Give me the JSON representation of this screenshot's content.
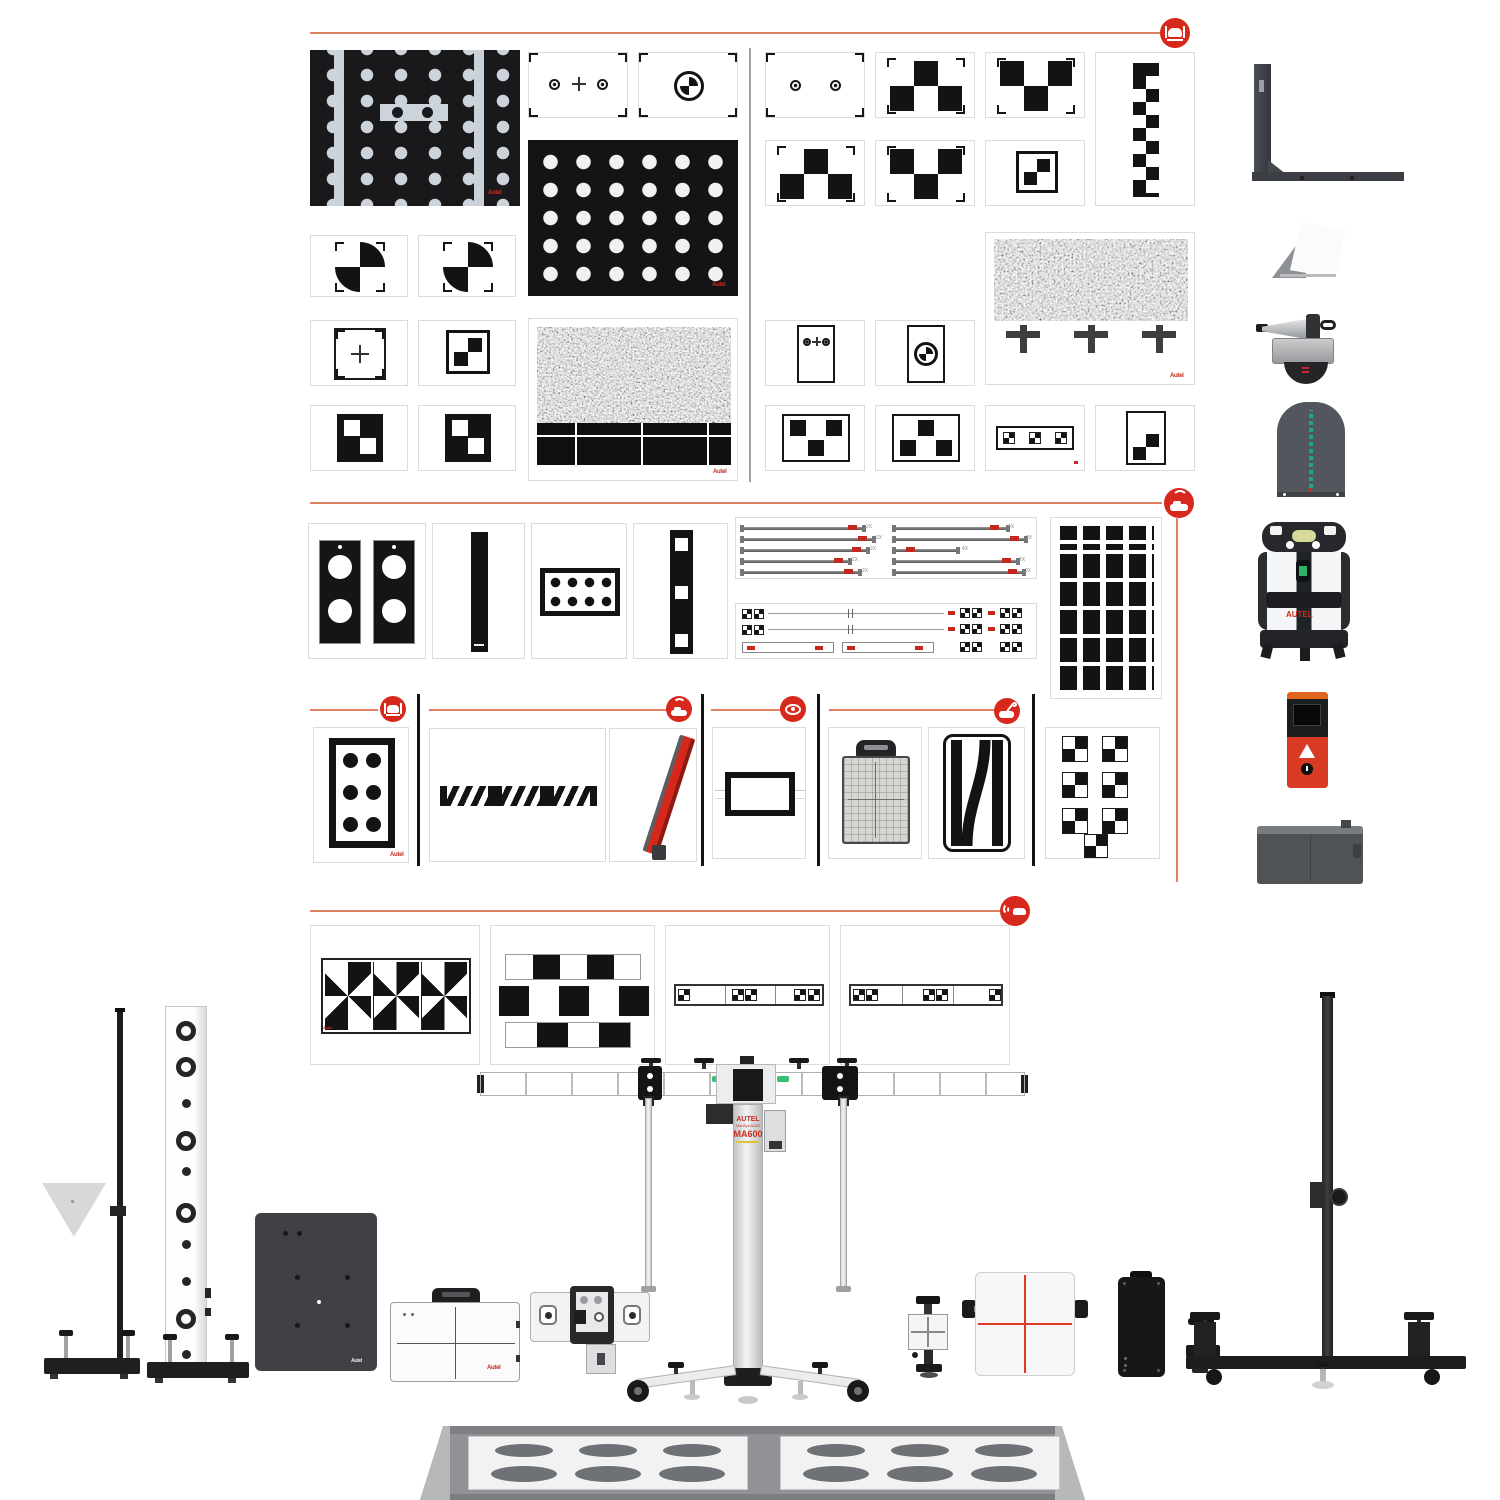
{
  "colors": {
    "accent_red": "#d6281c",
    "section_line": "#e08160",
    "teal": "#17a88e",
    "green": "#2fb36b",
    "board_dark": "#19191c"
  },
  "brand": {
    "logo": "Autel"
  },
  "ma600": {
    "brand": "AUTEL",
    "series": "MaxiSys ADAS",
    "model": "MA600"
  },
  "laser_level": {
    "brand": "AUTEL"
  },
  "rods": {
    "left": [
      "2X",
      "2X",
      "2X",
      "2X",
      "2X"
    ],
    "right": [
      "4X",
      "2X",
      "4X",
      "2X",
      "2X"
    ]
  },
  "sections": [
    {
      "id": "front-camera-targets",
      "icon": "car-camera-icon",
      "items": [
        "dot-matrix-board",
        "two-dot-cross-target",
        "roundel-target",
        "dot-matrix-board-2",
        "quadrant-target",
        "quadrant-target",
        "cross-target",
        "checker-frame-target",
        "noise-grid-target",
        "corner-checker-target",
        "corner-checker-target",
        "two-dot-target",
        "checkerboard-3x2",
        "checkerboard-3x2",
        "zigzag-checker-strip",
        "checkerboard-3x2",
        "checkerboard-3x2",
        "checker-2x2-frame",
        "noise-triple-cross-target",
        "portrait-two-dot-target",
        "portrait-roundel-target",
        "three-square-down-target",
        "three-square-up-target",
        "triple-checker-strip",
        "mini-checkerboard-target"
      ]
    },
    {
      "id": "radar-targets",
      "icon": "car-radar-icon",
      "items": [
        "double-circle-plates",
        "black-bar-target",
        "eight-dot-target",
        "three-square-bar",
        "telescoping-rods",
        "measuring-tapes",
        "grid-block-target"
      ]
    },
    {
      "id": "special-targets",
      "groups": [
        {
          "icon": "car-camera-icon",
          "items": [
            "six-dot-target"
          ]
        },
        {
          "icon": "car-radar-icon",
          "items": [
            "striped-bar-target",
            "red-reflector-panel"
          ]
        },
        {
          "icon": "eye-icon",
          "items": [
            "rectangle-frame-target"
          ]
        },
        {
          "icon": "car-service-icon",
          "items": [
            "grid-board-with-handle",
            "curve-stripe-target"
          ]
        },
        {
          "icon": "none",
          "items": [
            "scattered-checker-target"
          ]
        }
      ]
    },
    {
      "id": "avm-targets",
      "icon": "car-sound-icon",
      "items": [
        "pinwheel-target-strip",
        "checker-brick-strips",
        "checker-dash-strip",
        "checker-dash-strip-2"
      ]
    }
  ],
  "equipment": [
    "wall-bracket-panel",
    "corner-reflector-wedge",
    "doppler-simulator",
    "laser-reflector-plate",
    "laser-level",
    "laser-distance-meter",
    "storage-box",
    "triangle-pole-stand",
    "circle-pillar-stand",
    "metal-calibration-plate",
    "pattern-case",
    "target-mount-head",
    "ma600-calibration-frame",
    "jack-clamp-target",
    "crosshair-board",
    "battery-box",
    "clamp-tool",
    "t-bar-stand",
    "oval-floor-mat"
  ]
}
